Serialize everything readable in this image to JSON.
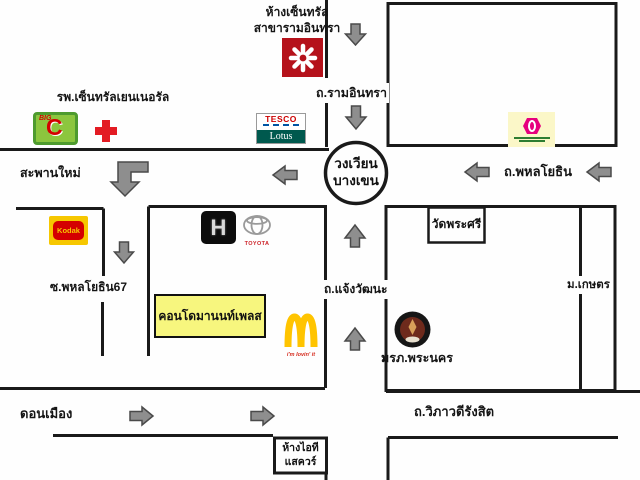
{
  "map": {
    "places": {
      "central_mall_line1": "ห้างเซ็นทรัล",
      "central_mall_line2": "สาขารามอินทรา",
      "hospital": "รพ.เซ็นทรัลเยนเนอรัล",
      "saphan_mai": "สะพานใหม่",
      "roundabout_line1": "วงเวียน",
      "roundabout_line2": "บางเขน",
      "wat_phra_si": "วัดพระศรี",
      "kasetsart_university": "ม.เกษตร",
      "soi_phahonyothin_67": "ซ.พหลโยธิน67",
      "condo_manon_place": "คอนโดมานนท์เพลส",
      "phranakhon_rajabhat": "มรภ.พระนคร",
      "don_mueang": "ดอนเมือง",
      "it_square_line1": "ห้างไอที",
      "it_square_line2": "แสควร์"
    },
    "roads": {
      "ramindra": "ถ.รามอินทรา",
      "phahonyothin": "ถ.พหลโยธิน",
      "chaeng_watthana": "ถ.แจ้งวัฒนะ",
      "vibhavadi_rangsit": "ถ.วิภาวดีรังสิต"
    },
    "logo_text": {
      "big_c_top": "BIG",
      "big_c_letter": "C",
      "tesco": "TESCO",
      "lotus": "Lotus",
      "toyota": "TOYOTA",
      "kodak": "Kodak",
      "honda_letter": "H",
      "mcdonalds_tagline": "i'm lovin' it"
    },
    "colors": {
      "road_line": "#1a1a1a",
      "arrow_fill": "#8e8e8e",
      "arrow_stroke": "#4a4a4a",
      "condo_box_bg": "#f7f67e",
      "central_red": "#b5121b",
      "big_c_green": "#8cc63e",
      "hospital_cross_red": "#e31b23",
      "tesco_red": "#cc0000",
      "lotus_teal": "#00594e",
      "sripatum_pink": "#e6007e",
      "sripatum_bg": "#fbf7c8",
      "kodak_yellow": "#f6c700",
      "kodak_red": "#d40000",
      "mcdonalds_yellow": "#ffc400",
      "mcdonalds_red": "#d52b1e",
      "toyota_red": "#cc2127"
    }
  }
}
